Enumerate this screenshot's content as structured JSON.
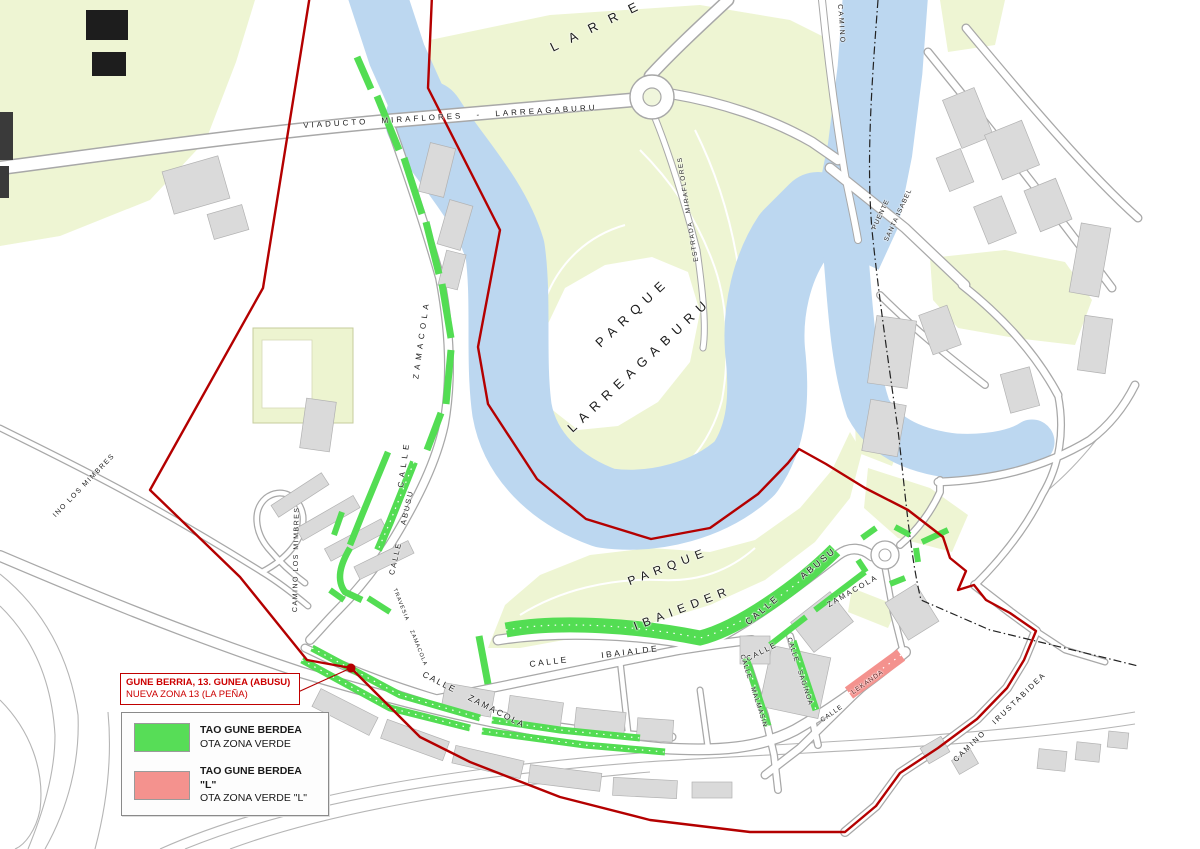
{
  "title_box": {
    "line1": "GUNE BERRIA, 13. GUNEA (ABUSU)",
    "line2": "NUEVA ZONA 13 (LA PEÑA)"
  },
  "legend": {
    "items": [
      {
        "swatch_color": "#57dd57",
        "line1": "TAO GUNE BERDEA",
        "line2": "OTA ZONA VERDE"
      },
      {
        "swatch_color": "#f4928e",
        "line1": "TAO GUNE BERDEA \"L\"",
        "line2": "OTA ZONA VERDE \"L\""
      }
    ]
  },
  "map_labels": {
    "viaducto": "VIADUCTO MIRAFLORES - LARREAGABURU",
    "larre_partial": "LARRE",
    "calle_zamacola_west": "CALLE ZAMACOLA",
    "parque_larreagaburu_1": "PARQUE",
    "parque_larreagaburu_2": "LARREAGABURU",
    "estrada_miraflores": "ESTRADA MIRAFLORES",
    "camino_top": "CAMINO",
    "puente_1": "PUENTE",
    "puente_2": "SANTA ISABEL",
    "parque_ibaieder_1": "PARQUE",
    "parque_ibaieder_2": "IBAIEDER",
    "calle_abusu_west": "CALLE ABUSU",
    "calle_abusu_band": "CALLE ABUSU",
    "zamacola_ne": "ZAMACOLA",
    "calle_ne": "CALLE",
    "calle_malmasin": "CALLE MALMASIN",
    "calle_sagino": "CALLE SAGINOA",
    "lekanda": "LEKANDA",
    "calle_lekanda": "CALLE",
    "calle_ibaialde": "CALLE IBAIALDE",
    "calle_zamacola_south": "CALLE ZAMACOLA",
    "travesia_zamacola": "TRAVESIA ZAMACOLA",
    "camino_los_mimbres": "CAMINO LOS MIMBRES",
    "mimbres_cut": "INO LOS MIMBRES",
    "camino_irustabidea": "CAMINO IRUSTABIDEA"
  },
  "colors": {
    "zone_boundary_red": "#b40000",
    "ota_green": "#53dd53",
    "ota_pink_l": "#f4928e",
    "river_blue": "#bcd7f0",
    "park_green": "#eef5d3",
    "building_gray": "#dadada",
    "title_text_red": "#cc0000"
  }
}
